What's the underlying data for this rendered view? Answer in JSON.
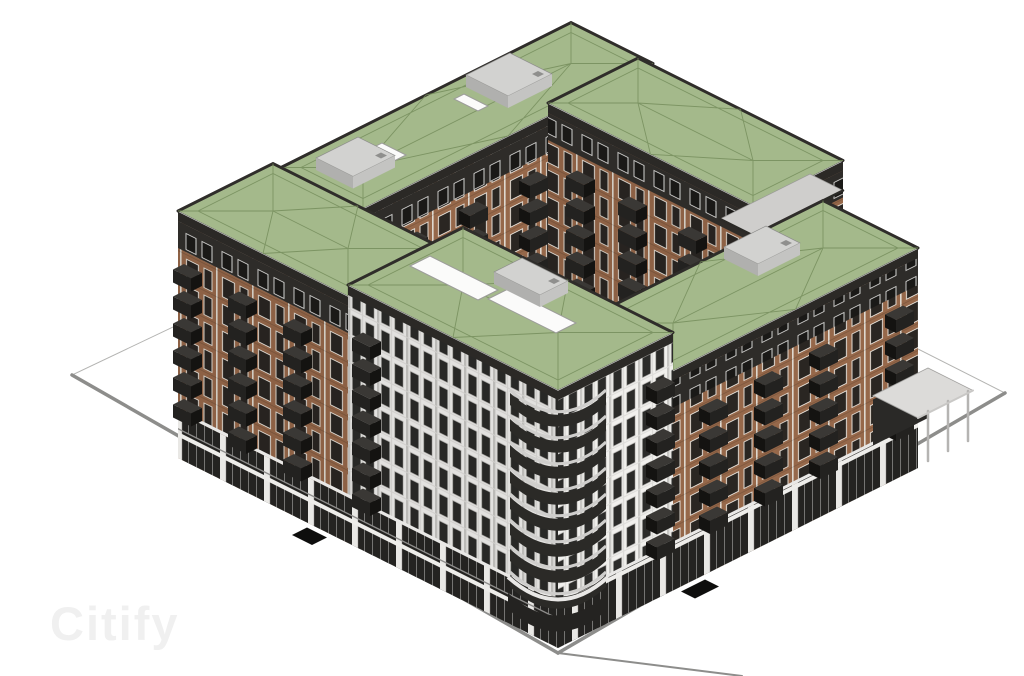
{
  "scene": {
    "title": "Axonometric 3D massing rendering of a courtyard apartment block with green roofs",
    "background": "#ffffff"
  },
  "watermark": {
    "text": "Citify"
  },
  "colors": {
    "background": "#ffffff",
    "roofGreen": "#a4b98b",
    "roofLine": "#768d5c",
    "roofEdgeDark": "#2f2d2a",
    "fascia": "#2b2926",
    "coping": "#ffffff",
    "charcoalWall": "#2e2c29",
    "charcoalWindowGlass": "#1a1917",
    "charcoalWindowFrame": "#dcdcda",
    "brick": "#96684a",
    "brickPier": "#ded8cf",
    "brickWindowGlass": "#2a2622",
    "brickWindowFrame": "#e9e4dc",
    "whiteWall": "#f1f0ed",
    "pilasterDark": "#c7c6c3",
    "pilasterLight": "#dbdad7",
    "whiteWindowGlass": "#2b2b29",
    "whiteWindowFrame": "#c4c3c0",
    "shopGlass": "#242321",
    "shopMullion": "#7d7c7a",
    "shopPier": "#e9e8e5",
    "shopBeam": "#eeedea",
    "ledge": "#e9e8e6",
    "balconyFront": "#232220",
    "balconySide": "#141311",
    "balconyTop": "#3a3835",
    "deckGray": "#cfcecc",
    "terrace": "#cfcecc",
    "railDark": "#2b2a27",
    "podium": "#e8e7e4",
    "hvacTop": "#d2d2d0",
    "hvacSideA": "#b0b0ae",
    "hvacSideB": "#c4c4c2",
    "hvacVent": "#8f8f8d",
    "skylight": "#fbfbfa",
    "skylightEdge": "#9c9c9a",
    "siteLine": "#b3b3b1",
    "curb": "#8d8d8b",
    "mat": "#0e0e0d",
    "pergolaSlab": "#dcdbd9",
    "pergolaEdge": "#a3a2a0",
    "pergolaPost": "#b5b4b2",
    "pergolaBack": "#2a2927",
    "shadeOverlay": "rgba(0,0,0,0.06)",
    "watermark": "#f0f0f0"
  },
  "site": {
    "outline": [
      [
        558,
        653
      ],
      [
        72,
        375
      ],
      [
        535,
        155
      ],
      [
        1005,
        393
      ]
    ],
    "curbs": [
      [
        [
          72,
          375
        ],
        [
          558,
          653
        ]
      ],
      [
        [
          558,
          653
        ],
        [
          1005,
          393
        ]
      ]
    ],
    "roadExtension": [
      [
        558,
        653
      ],
      [
        742,
        676
      ]
    ]
  },
  "blocks": [
    {
      "name": "back-wing",
      "u": [
        95,
        385
      ],
      "v": [
        290,
        372
      ],
      "h": 247,
      "faces": {
        "B": {
          "style": "brick",
          "topBand": true
        }
      },
      "stacks": {
        "B": [
          {
            "pos": 140,
            "n": 6
          },
          {
            "pos": 200,
            "n": 6
          },
          {
            "pos": 260,
            "n": 6
          }
        ]
      },
      "roof": {
        "ribs": true,
        "hvac": [
          {
            "u": [
              110,
              152
            ],
            "v": [
              315,
              352
            ]
          },
          {
            "u": [
              268,
              312
            ],
            "v": [
              318,
              360
            ]
          }
        ],
        "skylights": [
          {
            "u": [
              158,
              170
            ],
            "v": [
              322,
              346
            ]
          },
          {
            "u": [
              250,
              260
            ],
            "v": [
              330,
              354
            ]
          }
        ]
      }
    },
    {
      "name": "back-right-wing",
      "u": [
        290,
        380
      ],
      "v": [
        95,
        300
      ],
      "h": 250,
      "faces": {
        "A": {
          "style": "brick",
          "topBand": true
        },
        "B": {
          "style": "brick",
          "topBand": true
        }
      },
      "stacks": {
        "A": [
          {
            "pos": 150,
            "n": 6
          },
          {
            "pos": 210,
            "n": 6
          },
          {
            "pos": 262,
            "n": 6
          }
        ],
        "B": [
          {
            "pos": 325,
            "n": 6
          },
          {
            "pos": 357,
            "n": 6
          }
        ]
      },
      "roof": {
        "ribs": true
      },
      "terrace": {
        "u": [
          290,
          380
        ],
        "v": [
          95,
          128
        ],
        "h": 220
      }
    },
    {
      "name": "courtyard-podium",
      "podiumOnly": true,
      "u": [
        95,
        290
      ],
      "v": [
        95,
        290
      ],
      "h": 46
    },
    {
      "name": "left-wing",
      "u": [
        0,
        95
      ],
      "v": [
        210,
        380
      ],
      "h": 247,
      "faces": {
        "A": {
          "style": "brick",
          "topBand": true,
          "shop": true
        }
      },
      "stacks": {
        "A": [
          {
            "pos": 365,
            "n": 6
          },
          {
            "pos": 310,
            "n": 6
          },
          {
            "pos": 255,
            "n": 6
          }
        ]
      },
      "roof": {
        "ribs": true
      }
    },
    {
      "name": "right-wing",
      "u": [
        115,
        360
      ],
      "v": [
        0,
        95
      ],
      "h": 220,
      "faces": {
        "A": {
          "style": "white"
        },
        "B": {
          "style": "brick",
          "topBand": true,
          "shop": true
        }
      },
      "stacks": {
        "B": [
          {
            "pos": 150,
            "n": 5
          },
          {
            "pos": 205,
            "n": 5
          },
          {
            "pos": 260,
            "n": 5
          },
          {
            "pos": 336,
            "n": 5
          }
        ]
      },
      "roof": {
        "ribs": true,
        "hvac": [
          {
            "u": [
              252,
              294
            ],
            "v": [
              52,
              86
            ]
          }
        ]
      },
      "pergola": {
        "u": [
          360,
          415
        ],
        "v": [
          0,
          45
        ],
        "h": 50,
        "posts": [
          372,
          392,
          412
        ]
      }
    },
    {
      "name": "corner-tower",
      "u": [
        0,
        115
      ],
      "v": [
        0,
        210
      ],
      "h": 258,
      "faces": {
        "A": {
          "style": "white",
          "shop": true
        },
        "B": {
          "style": "white",
          "shop": true
        }
      },
      "stacks": {
        "A": [
          {
            "pos": 186,
            "n": 7,
            "dz": 26
          }
        ],
        "B": [
          {
            "pos": 97,
            "n": 7,
            "dz": 26
          }
        ]
      },
      "cornerBalconies": {
        "n": 8,
        "z0": 49,
        "dz": 26,
        "reach": 48
      },
      "roof": {
        "ribs": true,
        "skylights": [
          {
            "u": [
              50,
              70
            ],
            "v": [
              130,
              198
            ]
          },
          {
            "u": [
              56,
              76
            ],
            "v": [
              58,
              126
            ]
          }
        ],
        "hvac": [
          {
            "u": [
              74,
              102
            ],
            "v": [
              92,
              138
            ]
          }
        ]
      }
    }
  ],
  "mats": [
    {
      "u": [
        -20,
        -5
      ],
      "v": [
        226,
        246
      ]
    },
    {
      "u": [
        118,
        142
      ],
      "v": [
        -19,
        -5
      ]
    }
  ]
}
